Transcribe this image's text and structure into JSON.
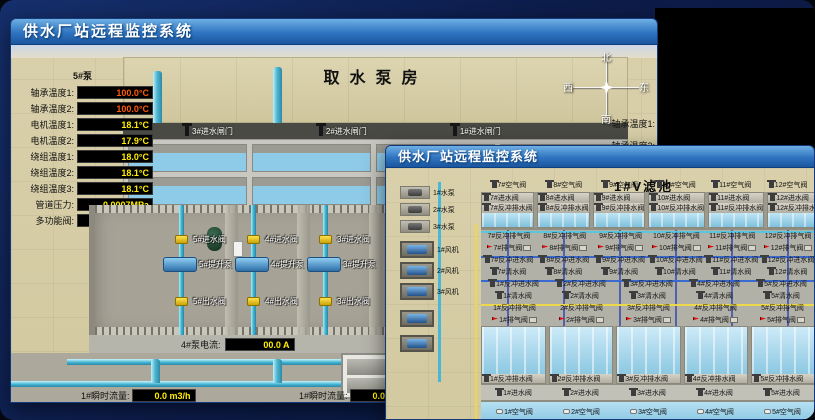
{
  "back_window": {
    "title": "供水厂站远程监控系统",
    "scene_title": "取水泵房",
    "pump_panel": {
      "header": "5#泵",
      "rows": [
        {
          "label": "轴承温度1:",
          "value": "100.0°C",
          "cls": "red"
        },
        {
          "label": "轴承温度2:",
          "value": "100.0°C",
          "cls": "red"
        },
        {
          "label": "电机温度1:",
          "value": "18.1°C",
          "cls": "yellow"
        },
        {
          "label": "电机温度2:",
          "value": "17.9°C",
          "cls": "yellow"
        },
        {
          "label": "绕组温度1:",
          "value": "18.0°C",
          "cls": "yellow"
        },
        {
          "label": "绕组温度2:",
          "value": "18.1°C",
          "cls": "yellow"
        },
        {
          "label": "绕组温度3:",
          "value": "18.1°C",
          "cls": "yellow"
        },
        {
          "label": "管道压力:",
          "value": "0.0007MPa",
          "cls": "yellow"
        },
        {
          "label": "多功能阀:",
          "value": "0%",
          "cls": "yellow"
        }
      ]
    },
    "intake_gates": [
      "3#进水闸门",
      "2#进水闸门",
      "1#进水闸门"
    ],
    "pump_columns": [
      {
        "valve_in": "5#进水阀",
        "pump": "5#提升泵",
        "valve_out": "5#出水阀"
      },
      {
        "valve_in": "4#进水阀",
        "pump": "4#提升泵",
        "valve_out": "4#出水阀"
      },
      {
        "valve_in": "3#进水阀",
        "pump": "3#提升泵",
        "valve_out": "3#出水阀"
      }
    ],
    "current_readout": {
      "label": "4#泵电流:",
      "value": "00.0 A"
    },
    "current_readout2_label": "2#泵电流:",
    "flow_readouts": [
      {
        "label": "1#瞬时流量:",
        "value": "0.0 m3/h"
      },
      {
        "label": "1#瞬时流量:",
        "value": "0.0 m3/h"
      }
    ],
    "compass": {
      "north": "北",
      "south": "南",
      "west": "西",
      "east": "东"
    },
    "side_labels": [
      "轴承温度1:",
      "轴承温度2:"
    ]
  },
  "front_window": {
    "title": "供水厂站远程监控系统",
    "scene_title": "1#V滤池",
    "left_pumps": [
      "1#水泵",
      "2#水泵",
      "3#水泵"
    ],
    "left_fans": [
      "1#风机",
      "2#风机",
      "3#风机"
    ],
    "top_cells": [
      {
        "air": "7#空气阀",
        "inlet": "7#进水阀",
        "drain": "7#反冲排水阀",
        "bw_exhaust": "7#反冲排气阀",
        "exhaust": "7#排气阀",
        "bw_inlet": "7#反冲进水阀",
        "clean": "7#清水阀"
      },
      {
        "air": "8#空气阀",
        "inlet": "8#进水阀",
        "drain": "8#反冲排水阀",
        "bw_exhaust": "8#反冲排气阀",
        "exhaust": "8#排气阀",
        "bw_inlet": "8#反冲进水阀",
        "clean": "8#清水阀"
      },
      {
        "air": "9#空气阀",
        "inlet": "9#进水阀",
        "drain": "9#反冲排水阀",
        "bw_exhaust": "9#反冲排气阀",
        "exhaust": "9#排气阀",
        "bw_inlet": "9#反冲进水阀",
        "clean": "9#清水阀"
      },
      {
        "air": "10#空气阀",
        "inlet": "10#进水阀",
        "drain": "10#反冲排水阀",
        "bw_exhaust": "10#反冲排气阀",
        "exhaust": "10#排气阀",
        "bw_inlet": "10#反冲进水阀",
        "clean": "10#清水阀"
      },
      {
        "air": "11#空气阀",
        "inlet": "11#进水阀",
        "drain": "11#反冲排水阀",
        "bw_exhaust": "11#反冲排气阀",
        "exhaust": "11#排气阀",
        "bw_inlet": "11#反冲进水阀",
        "clean": "11#清水阀"
      },
      {
        "air": "12#空气阀",
        "inlet": "12#进水阀",
        "drain": "12#反冲排水阀",
        "bw_exhaust": "12#反冲排气阀",
        "exhaust": "12#排气阀",
        "bw_inlet": "12#反冲进水阀",
        "clean": "12#清水阀"
      }
    ],
    "bottom_cells": [
      {
        "bw_inlet": "1#反冲进水阀",
        "clean": "1#清水阀",
        "bw_exhaust": "1#反冲排气阀",
        "exhaust": "1#排气阀",
        "drain": "1#反冲排水阀",
        "inlet": "1#进水阀",
        "air": "1#空气阀"
      },
      {
        "bw_inlet": "2#反冲进水阀",
        "clean": "2#清水阀",
        "bw_exhaust": "2#反冲排气阀",
        "exhaust": "2#排气阀",
        "drain": "2#反冲排水阀",
        "inlet": "2#进水阀",
        "air": "2#空气阀"
      },
      {
        "bw_inlet": "3#反冲进水阀",
        "clean": "3#清水阀",
        "bw_exhaust": "3#反冲排气阀",
        "exhaust": "3#排气阀",
        "drain": "3#反冲排水阀",
        "inlet": "3#进水阀",
        "air": "3#空气阀"
      },
      {
        "bw_inlet": "4#反冲进水阀",
        "clean": "4#清水阀",
        "bw_exhaust": "4#反冲排气阀",
        "exhaust": "4#排气阀",
        "drain": "4#反冲排水阀",
        "inlet": "4#进水阀",
        "air": "4#空气阀"
      },
      {
        "bw_inlet": "5#反冲进水阀",
        "clean": "5#清水阀",
        "bw_exhaust": "5#反冲排气阀",
        "exhaust": "5#排气阀",
        "drain": "5#反冲排水阀",
        "inlet": "5#进水阀",
        "air": "5#空气阀"
      }
    ]
  },
  "colors": {
    "accent_titlebar": "#2f74c0",
    "value_yellow": "#ffee00",
    "alarm_red": "#ff5a00",
    "water_blue": "#8ecbe8",
    "floor_tan": "#d2c9a0"
  }
}
